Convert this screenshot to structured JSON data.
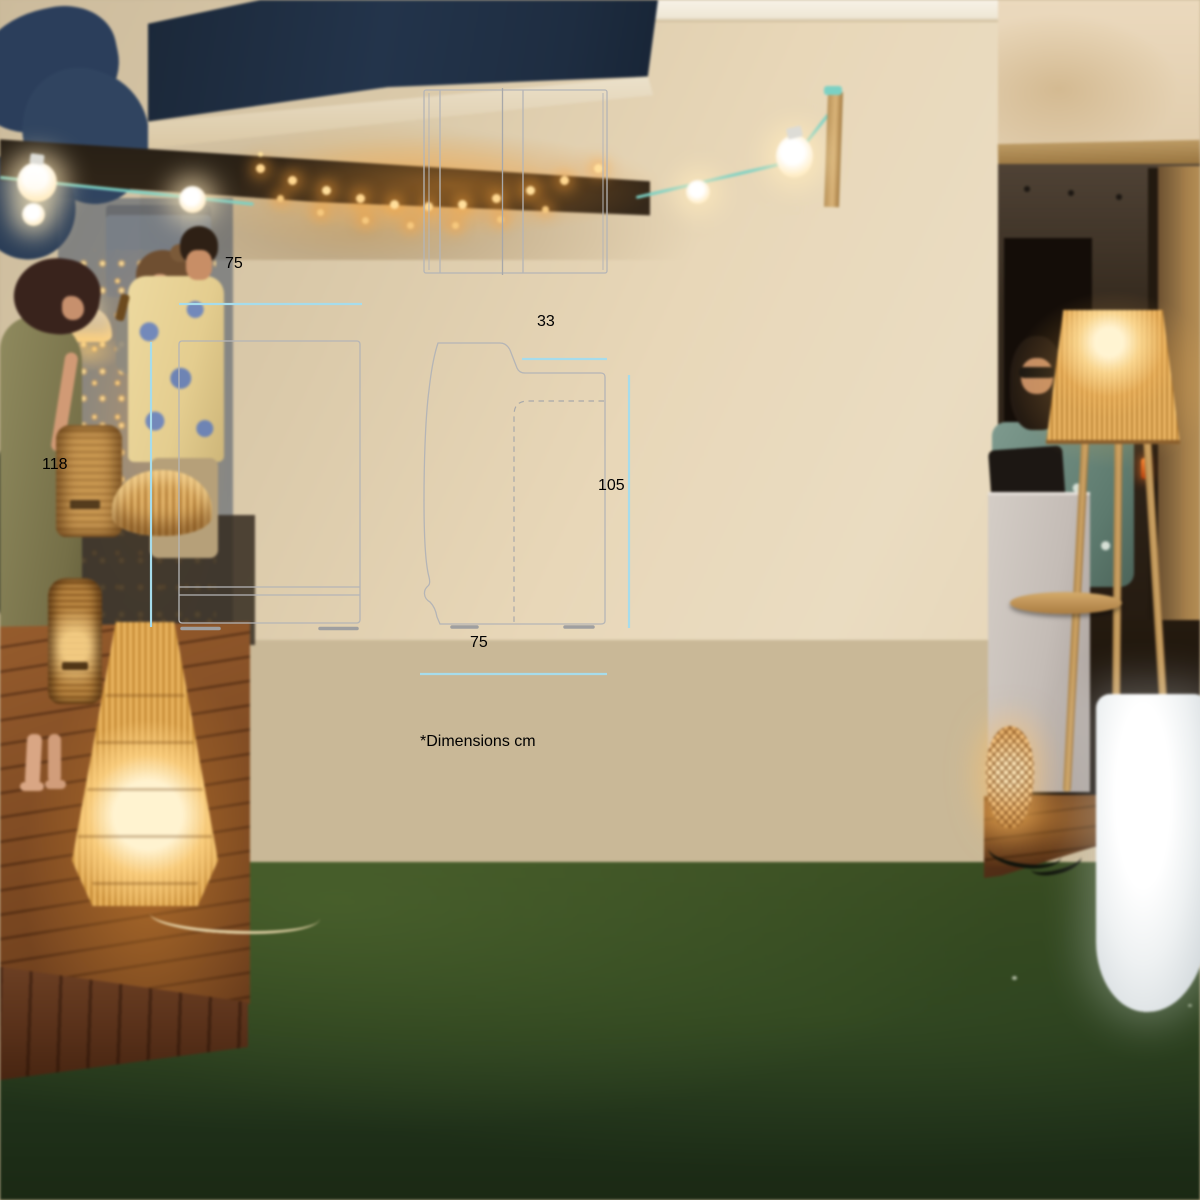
{
  "diagram": {
    "footnote": "*Dimensions cm",
    "dimensions": {
      "front_width": "75",
      "front_height": "118",
      "side_top_depth": "33",
      "side_height": "105",
      "side_depth": "75"
    }
  },
  "colors": {
    "panel_background": "#ffffff",
    "dimension_line": "#a6dcec",
    "dimension_text": "#8b8a8d",
    "drawing_stroke": "#b5b5b6"
  }
}
